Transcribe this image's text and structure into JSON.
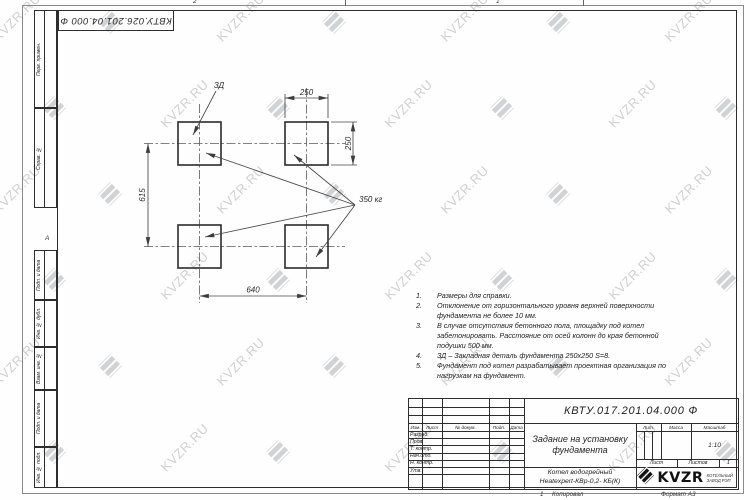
{
  "watermark": {
    "text": "KVZR.RU"
  },
  "top_designation": "КВТУ.026.201.04.000 Ф",
  "zones": {
    "top_left_num": "2",
    "top_right_num": "1",
    "left_letter": "А"
  },
  "side_columns": [
    "Перв. примен.",
    "Справ. №",
    "Подп. и дата",
    "Инв. № дубл.",
    "Взам. инв. №",
    "Подп. и дата",
    "Инв. № подл."
  ],
  "drawing": {
    "dim_top": "250",
    "dim_right": "250",
    "dim_left": "615",
    "dim_bottom": "640",
    "embed_label": "ЗД",
    "load_label": "350 кг"
  },
  "notes": [
    {
      "n": "1.",
      "text": "Размеры для справки."
    },
    {
      "n": "2.",
      "text": "Отклонение от горизонтального уровня верхней поверхности фундамента не более 10 мм."
    },
    {
      "n": "3.",
      "text": "В случае отсутствия бетонного пола, площадку под котел забетонировать. Расстояние от осей колонн до края бетонной подушки 500 мм."
    },
    {
      "n": "4.",
      "text": "ЗД – Закладная деталь фундамента 250х250 S=8."
    },
    {
      "n": "5.",
      "text": "Фундамент под котел разрабатывает проектная организация по нагрузкам на фундамент."
    }
  ],
  "title_block": {
    "designation": "КВТУ.017.201.04.000 Ф",
    "doc_title": "Задание на установку фундамента",
    "product_line1": "Котел водогрейный",
    "product_line2": "Heatexpert-КВр-0,2- КБ(К)",
    "cols": [
      "Изм.",
      "Лист",
      "№ докум.",
      "Подп.",
      "Дата"
    ],
    "rows": [
      "Разраб.",
      "Пров.",
      "Т. контр.",
      "Нач.отд.",
      "Н. контр.",
      "Утв."
    ],
    "lit_label": "Лит.",
    "mass_label": "Масса",
    "scale_label": "Масштаб",
    "scale_value": "1:10",
    "sheet_label": "Лист",
    "sheets_label": "Листов",
    "sheets_value": "1",
    "logo_text": "KVZR",
    "logo_sub1": "КОТЕЛЬНЫЙ",
    "logo_sub2": "ЗАВОД РЭП"
  },
  "footer": {
    "num": "1",
    "copied": "Копировал",
    "format": "Формат А3"
  }
}
